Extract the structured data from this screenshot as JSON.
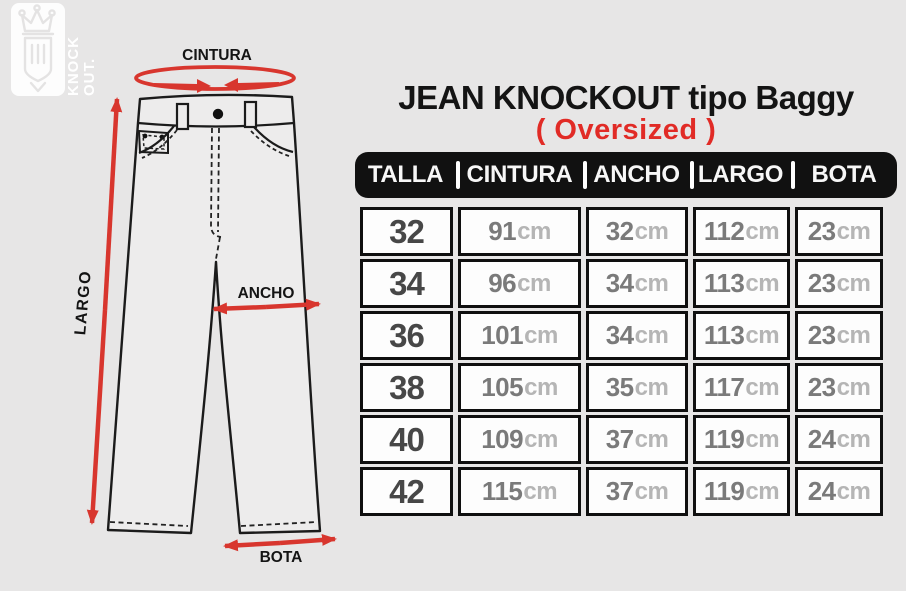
{
  "brand": {
    "name": "Knockout",
    "logo_line1": "KNOCK",
    "logo_line2": "OUT.",
    "crown_icon": "crown-shield-icon"
  },
  "title": "JEAN KNOCKOUT tipo Baggy",
  "subtitle": "( Oversized )",
  "diagram": {
    "waist_label": "CINTURA",
    "length_label": "LARGO",
    "width_label": "ANCHO",
    "hem_label": "BOTA"
  },
  "table": {
    "headers": [
      "TALLA",
      "CINTURA",
      "ANCHO",
      "LARGO",
      "BOTA"
    ],
    "unit": "cm",
    "rows": [
      [
        "32",
        "91",
        "32",
        "112",
        "23"
      ],
      [
        "34",
        "96",
        "34",
        "113",
        "23"
      ],
      [
        "36",
        "101",
        "34",
        "113",
        "23"
      ],
      [
        "38",
        "105",
        "35",
        "117",
        "23"
      ],
      [
        "40",
        "109",
        "37",
        "119",
        "24"
      ],
      [
        "42",
        "115",
        "37",
        "119",
        "24"
      ]
    ]
  },
  "colors": {
    "background": "#e7e6e6",
    "accent_red": "#e12b26",
    "arrow_red": "#d8362e",
    "header_bg": "#111111",
    "cell_bg": "#fdfdfd",
    "size_text": "#474747",
    "value_text": "#7a7a7a",
    "unit_text": "#b5b5b5"
  }
}
